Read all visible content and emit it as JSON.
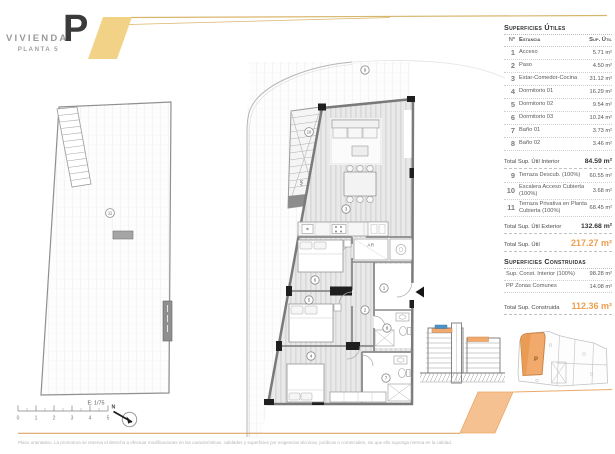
{
  "header": {
    "brand": "VIVIENDA",
    "floor_label": "PLANTA 5",
    "unit_letter": "P"
  },
  "surface_table": {
    "title": "Superficies Útiles",
    "col_num": "Nº",
    "col_room": "Estancia",
    "col_area": "Sup. Útil",
    "rows": [
      {
        "num": "1",
        "label": "Acceso",
        "value": "5.71 m²"
      },
      {
        "num": "2",
        "label": "Paso",
        "value": "4.50 m²"
      },
      {
        "num": "3",
        "label": "Estar-Comedor-Cocina",
        "value": "31.12 m²"
      },
      {
        "num": "4",
        "label": "Dormitorio 01",
        "value": "16.29 m²"
      },
      {
        "num": "5",
        "label": "Dormitorio 02",
        "value": "9.54 m²"
      },
      {
        "num": "6",
        "label": "Dormitorio 03",
        "value": "10.24 m²"
      },
      {
        "num": "7",
        "label": "Baño 01",
        "value": "3.73 m²"
      },
      {
        "num": "8",
        "label": "Baño 02",
        "value": "3.46 m²"
      }
    ],
    "total_interior_label": "Total Sup. Útil Interior",
    "total_interior_value": "84.59 m²",
    "exterior_rows": [
      {
        "num": "9",
        "label": "Terraza Descub. (100%)",
        "value": "60.55 m²"
      },
      {
        "num": "10",
        "label": "Escalera Acceso Cubierta (100%)",
        "value": "3.68 m²"
      },
      {
        "num": "11",
        "label": "Terraza Privativa en Planta Cubierta (100%)",
        "value": "68.45 m²"
      }
    ],
    "total_exterior_label": "Total Sup. Útil Exterior",
    "total_exterior_value": "132.68 m²",
    "total_label": "Total Sup. Útil",
    "total_value": "217.27 m²",
    "built_title": "Superficies Construidas",
    "built_rows": [
      {
        "label": "Sup. Const. Interior (100%)",
        "value": "98.28 m²"
      },
      {
        "label": "PP Zonas Comunes",
        "value": "14.08 m²"
      }
    ],
    "total_built_label": "Total Sup. Construida",
    "total_built_value": "112.36 m²"
  },
  "plan": {
    "ar_label": "AR",
    "markers": {
      "m1": "1",
      "m2": "2",
      "m3": "3",
      "m4": "4",
      "m5": "5",
      "m6": "6",
      "m7": "7",
      "m8": "8",
      "m9": "9",
      "m10": "10",
      "m11": "11"
    }
  },
  "scale_bar": {
    "label": "E: 1/75",
    "ticks": [
      "0",
      "1",
      "2",
      "3",
      "4",
      "5"
    ],
    "north_label": "N"
  },
  "key_plan": {
    "unit_label": "P"
  },
  "footer": {
    "disclaimer": "Plano orientativo. La promotora se reserva el derecho a efectuar modificaciones en las características, calidades y superficies por exigencias técnicas, jurídicas o comerciales, sin que ello suponga merma en la calidad."
  },
  "colors": {
    "brand_yellow": "#F2D286",
    "accent_orange": "#F6C190",
    "total_orange": "#EE9F4E",
    "keyplan_orange": "#F2A96C",
    "section_blue": "#4D93C8"
  }
}
